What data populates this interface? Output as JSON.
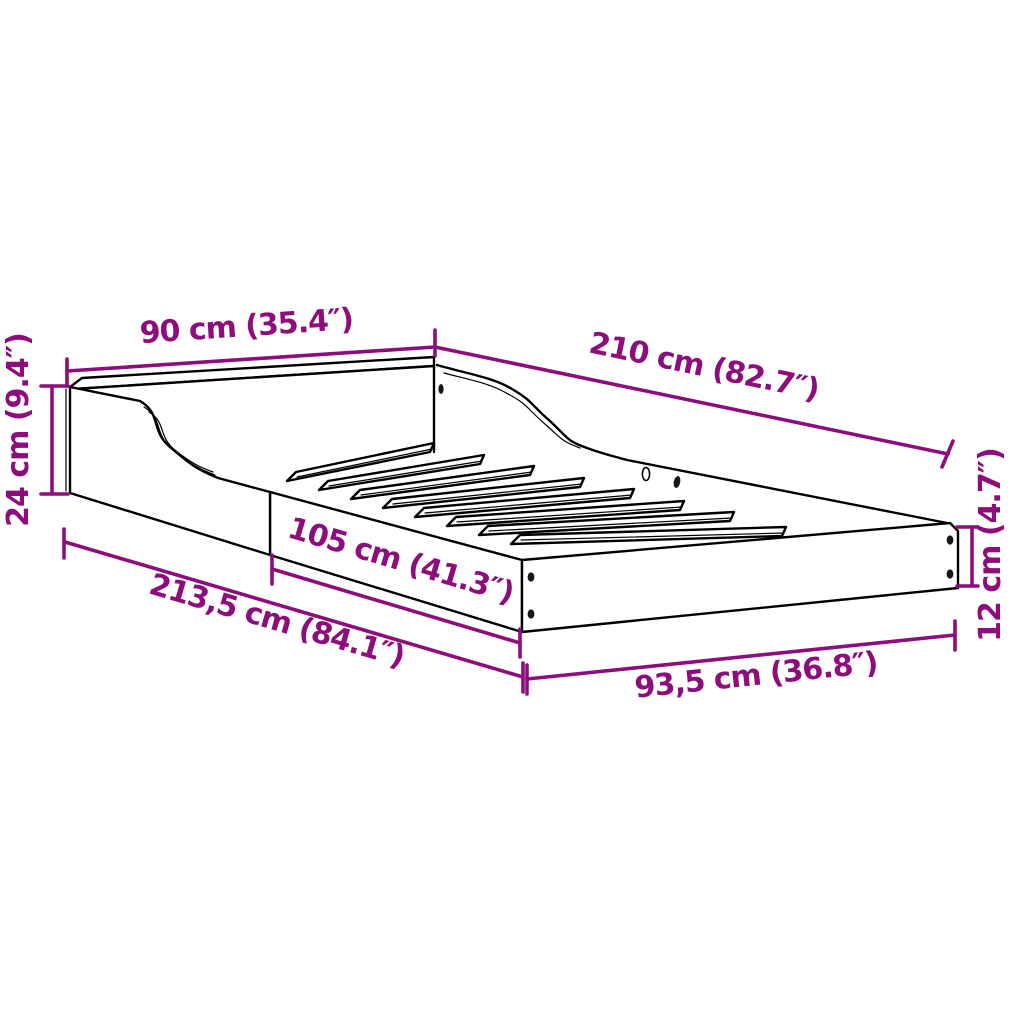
{
  "figure": {
    "type": "product-dimension-diagram",
    "subject": "bed-frame",
    "colors": {
      "background": "#ffffff",
      "outline": "#000000",
      "dimension": "#8E0D7C"
    }
  },
  "dimensions": [
    {
      "name": "headboard-width",
      "label": "90 cm (35.4″)"
    },
    {
      "name": "frame-length-top",
      "label": "210 cm (82.7″)"
    },
    {
      "name": "headboard-height",
      "label": "24 cm (9.4″)"
    },
    {
      "name": "low-rail-length",
      "label": "105 cm (41.3″)"
    },
    {
      "name": "side-rail-length",
      "label": "213,5 cm (84.1″)"
    },
    {
      "name": "foot-width",
      "label": "93,5 cm (36.8″)"
    },
    {
      "name": "foot-height",
      "label": "12 cm (4.7″)"
    }
  ]
}
